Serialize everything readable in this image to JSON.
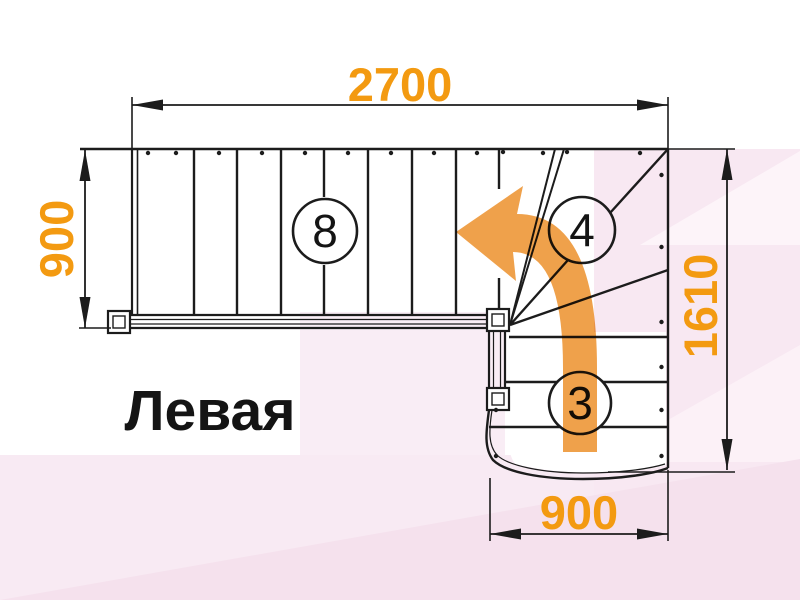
{
  "title": "Левая",
  "dimensions": {
    "top": "2700",
    "left": "900",
    "right": "1610",
    "bottom": "900"
  },
  "step_counts": {
    "upper_flight": "8",
    "winder_steps": "4",
    "lower_flight": "3"
  },
  "colors": {
    "dimension_orange": "#f39a11",
    "arrow_orange": "#efa14b",
    "line_black": "#1c1c1c",
    "background_pink": "#f8e8f2"
  }
}
